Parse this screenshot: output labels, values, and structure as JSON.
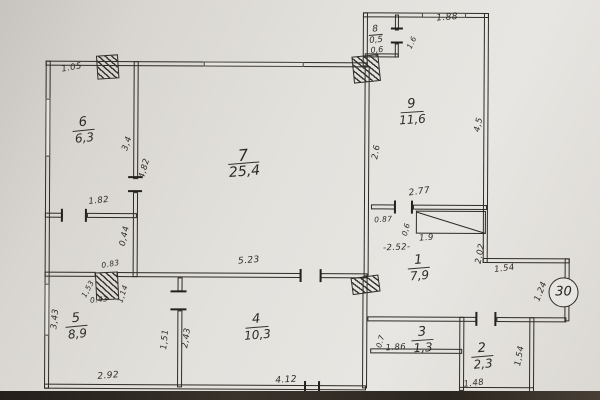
{
  "colors": {
    "paper": "#e6e4df",
    "ink": "#2e2b27",
    "photo_edge": "#2c2620"
  },
  "plan": {
    "apartment_circle": "30",
    "rooms": {
      "r7": {
        "num": "7",
        "area": "25,4"
      },
      "r6": {
        "num": "6",
        "area": "6,3"
      },
      "r9": {
        "num": "9",
        "area": "11,6"
      },
      "r8": {
        "num": "8",
        "area": "0,5",
        "sub": "0,6"
      },
      "r1": {
        "num": "1",
        "area": "7,9"
      },
      "r5": {
        "num": "5",
        "area": "8,9"
      },
      "r4": {
        "num": "4",
        "area": "10,3"
      },
      "r3": {
        "num": "3",
        "area": "1,3"
      },
      "r2": {
        "num": "2",
        "area": "2,3"
      }
    },
    "dims": {
      "top_left": "1.05",
      "room9_top": "1.88",
      "room8_door": "1.6",
      "room6_right_a": "3,4",
      "room6_right_b": "4,82",
      "room6_bottom": "1.82",
      "below_room6": "0,44",
      "left_wall": "3,43",
      "room9_left": "2.6",
      "room9_right": "4,5",
      "room9_bottom": "2.77",
      "hall_seg": "0.87",
      "hall_seg_small": "0,6",
      "closet": "1.9",
      "hall_width": "-2.52-",
      "hall_right": "2.02",
      "porch_top": "1.54",
      "porch_side": "1.24",
      "room4_top": "5.23",
      "vent_top": "0.83",
      "vent_left": "1,53",
      "vent_right": "1,14",
      "vent_bottom": "0.43",
      "door54_left": "1,51",
      "door54_right": "2,43",
      "room5_bottom": "2.92",
      "room4_bottom": "4.12",
      "room3_left": "0.7",
      "room3_bottom": "1.86",
      "room2_bottom": "1.48",
      "room2_right": "1,54"
    }
  }
}
